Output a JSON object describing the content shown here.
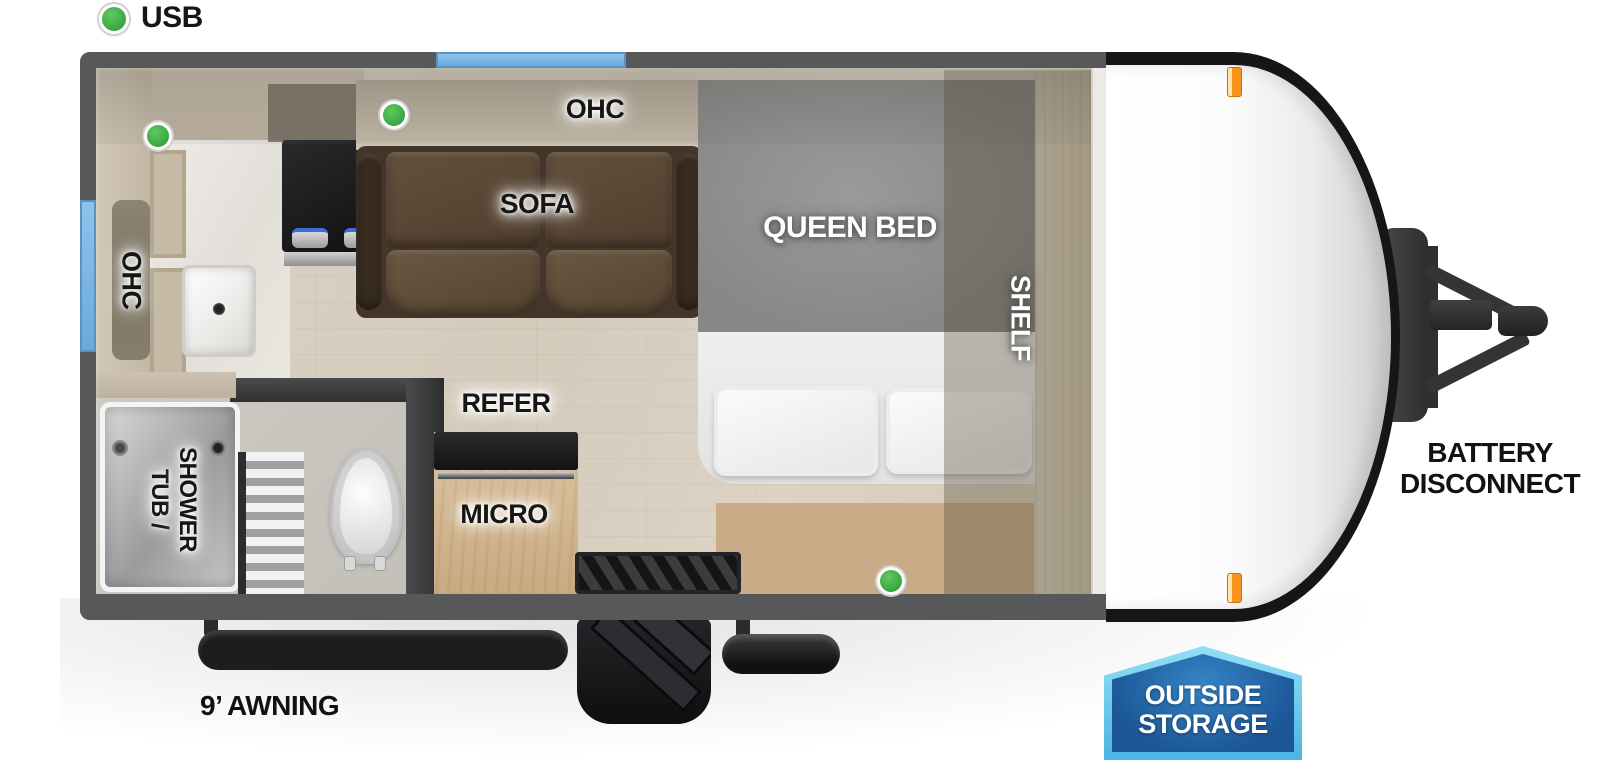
{
  "legend": {
    "usb": "USB"
  },
  "labels": {
    "kitchen_ohc": "OHC",
    "living_ohc": "OHC",
    "sofa": "SOFA",
    "queen_bed": "QUEEN BED",
    "shelf": "SHELF",
    "refer": "REFER",
    "micro": "MICRO",
    "tub_shower_line1": "TUB /",
    "tub_shower_line2": "SHOWER"
  },
  "exterior": {
    "battery_line1": "BATTERY",
    "battery_line2": "DISCONNECT",
    "awning": "9’ AWNING",
    "storage_line1": "OUTSIDE",
    "storage_line2": "STORAGE"
  },
  "icons": {
    "usb_port": "green-circle",
    "window": "blue-strip",
    "marker_light": "orange-lens"
  },
  "colors": {
    "usb_green": "#3fae48",
    "window_blue": "#74b5e4",
    "marker_orange": "#f7941d",
    "wall_gray": "#57585a",
    "storage_badge_border": "#5ec7ec",
    "storage_badge_fill": "#1d5c9e",
    "sofa_brown": "#5a4634"
  }
}
